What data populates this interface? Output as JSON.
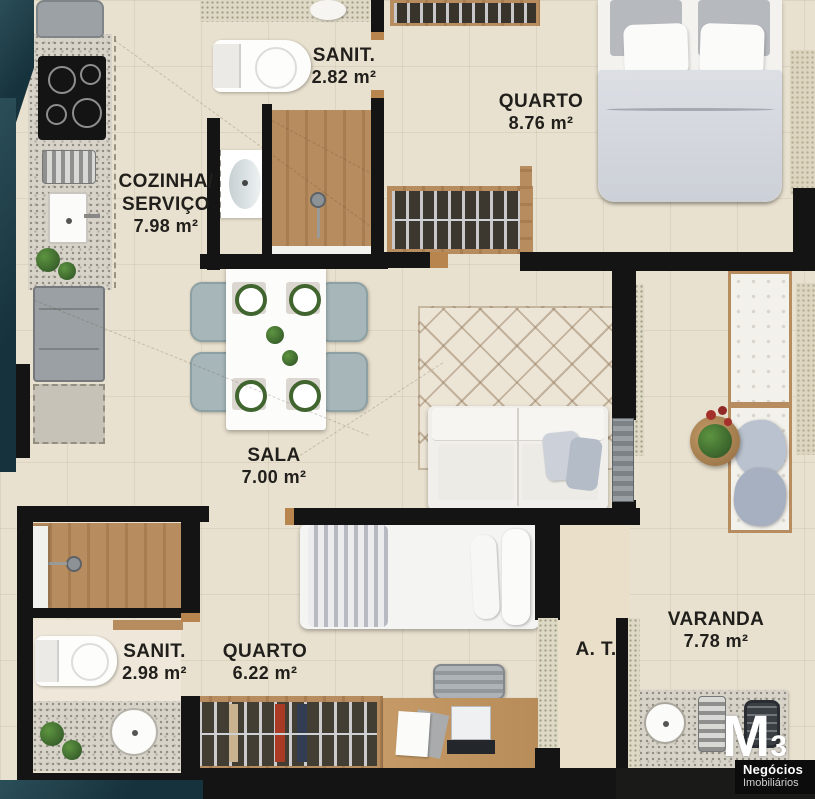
{
  "rooms": {
    "sanit1": {
      "name": "SANIT.",
      "area": "2.82 m²"
    },
    "quarto1": {
      "name": "QUARTO",
      "area": "8.76 m²"
    },
    "cozinha": {
      "line1": "COZINHA/",
      "line2": "SERVIÇO",
      "area": "7.98 m²"
    },
    "sala": {
      "name": "SALA",
      "area": "7.00 m²"
    },
    "sanit2": {
      "name": "SANIT.",
      "area": "2.98 m²"
    },
    "quarto2": {
      "name": "QUARTO",
      "area": "6.22 m²"
    },
    "at": {
      "name": "A. T."
    },
    "varanda": {
      "name": "VARANDA",
      "area": "7.78 m²"
    }
  },
  "logo": {
    "mark": "M",
    "digit": "3",
    "line1": "Negócios",
    "line2": "Imobiliários"
  },
  "colors": {
    "wall": "#141414",
    "outside_teal": "#16323c",
    "floor": "#e9e1cf",
    "wood": "#b78c5e",
    "chair_teal": "#a7b7b9",
    "plate_ring": "#41652e"
  }
}
